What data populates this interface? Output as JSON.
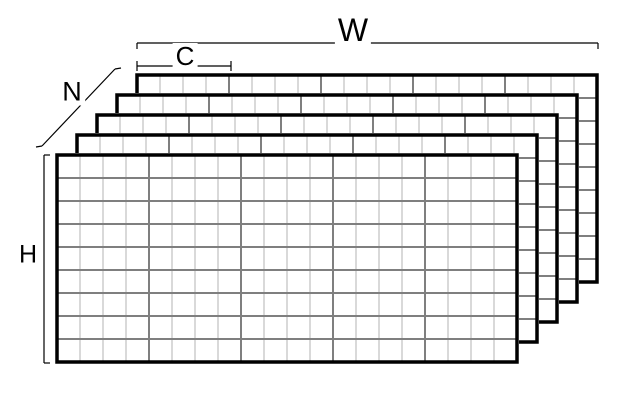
{
  "diagram": {
    "type": "tensor-layout",
    "labels": {
      "w": "W",
      "c": "C",
      "n": "N",
      "h": "H"
    },
    "colors": {
      "background": "#ffffff",
      "plane_border": "#000000",
      "grid_major": "#7f7f7f",
      "grid_minor": "#d9d9d9",
      "dimension_line": "#000000",
      "label_text": "#000000"
    },
    "tensor_planes": {
      "planes": 5,
      "cols": 20,
      "rows": 9,
      "cell": 23,
      "group_size": 4,
      "front_origin": [
        57,
        155
      ],
      "plane_offset": [
        20,
        -20
      ],
      "border_width": 3.5,
      "line_width": 2
    },
    "dimension_lines": {
      "w": {
        "segments": [
          [
            137,
            43,
            598,
            43
          ],
          [
            137,
            43,
            137,
            49
          ],
          [
            598,
            43,
            598,
            49
          ]
        ]
      },
      "c": {
        "segments": [
          [
            137,
            66,
            231,
            66
          ],
          [
            137,
            61,
            137,
            71
          ],
          [
            231,
            61,
            231,
            71
          ]
        ]
      },
      "h": {
        "segments": [
          [
            44,
            155,
            44,
            363
          ],
          [
            44,
            155,
            50,
            155
          ],
          [
            44,
            363,
            50,
            363
          ]
        ]
      },
      "n": {
        "segments": [
          [
            115,
            69,
            42,
            146
          ],
          [
            115,
            69,
            121,
            68
          ],
          [
            42,
            146,
            36,
            147
          ]
        ]
      }
    }
  }
}
